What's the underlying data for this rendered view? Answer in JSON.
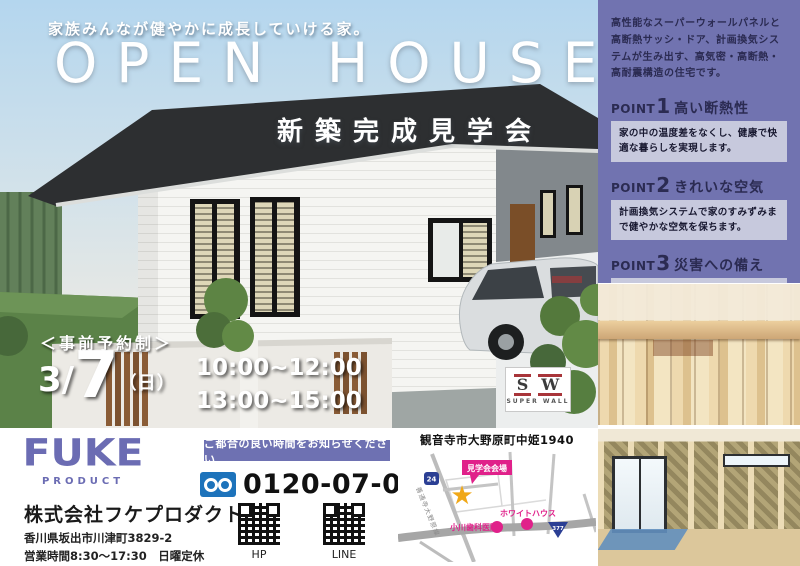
{
  "hero": {
    "tagline": "家族みんなが健やかに成長していける家。",
    "title": "OPEN HOUSE",
    "subtitle": "新築完成見学会",
    "reservation": "＜事前予約制＞",
    "date_prefix": "3/",
    "date_day": "7",
    "date_weekday": "（日）",
    "time_morning": "10:00~12:00",
    "time_afternoon": "13:00~15:00",
    "sw_logo": {
      "s": "S",
      "w": "W",
      "caption": "SUPER WALL"
    }
  },
  "sidebar": {
    "intro": "高性能なスーパーウォールパネルと高断熱サッシ・ドア、計画換気システムが生み出す、高気密・高断熱・高耐震構造の住宅です。",
    "points": [
      {
        "label": "POINT",
        "number": "1",
        "title": "高い断熱性",
        "description": "家の中の温度差をなくし、健康で快適な暮らしを実現します。"
      },
      {
        "label": "POINT",
        "number": "2",
        "title": "きれいな空気",
        "description": "計画換気システムで家のすみずみまで健やかな空気を保ちます。"
      },
      {
        "label": "POINT",
        "number": "3",
        "title": "災害への備え",
        "description": "モノコック構造が地震・台風など自然災害から家族を守ります。"
      }
    ]
  },
  "footer": {
    "logo_text": "FUKE",
    "logo_sub": "PRODUCT",
    "company_name": "株式会社フケプロダクト",
    "address": "香川県坂出市川津町3829-2",
    "hours": "営業時間8:30～17:30　日曜定休",
    "contact_banner": "ご都合の良い時間をお知らせください",
    "phone": "0120-07-0044",
    "qr_hp_label": "HP",
    "qr_line_label": "LINE"
  },
  "map": {
    "title": "観音寺市大野原町中姫1940",
    "venue_label": "見学会会場",
    "venue_star": "★",
    "landmark_dental": "小川歯科医院",
    "landmark_whitehouse": "ホワイトハウス",
    "road_name": "善通寺大野原線",
    "route_24": "24",
    "route_377": "377"
  },
  "colors": {
    "panel_purple": "#7173b0",
    "point_box": "#c7c9dd",
    "logo_blue": "#6b6cb3",
    "banner_purple": "#6e71b2",
    "map_pink": "#e0218a",
    "star_gold": "#f0a818",
    "route_blue": "#2b3f94",
    "freedial_blue": "#1d73bb"
  }
}
